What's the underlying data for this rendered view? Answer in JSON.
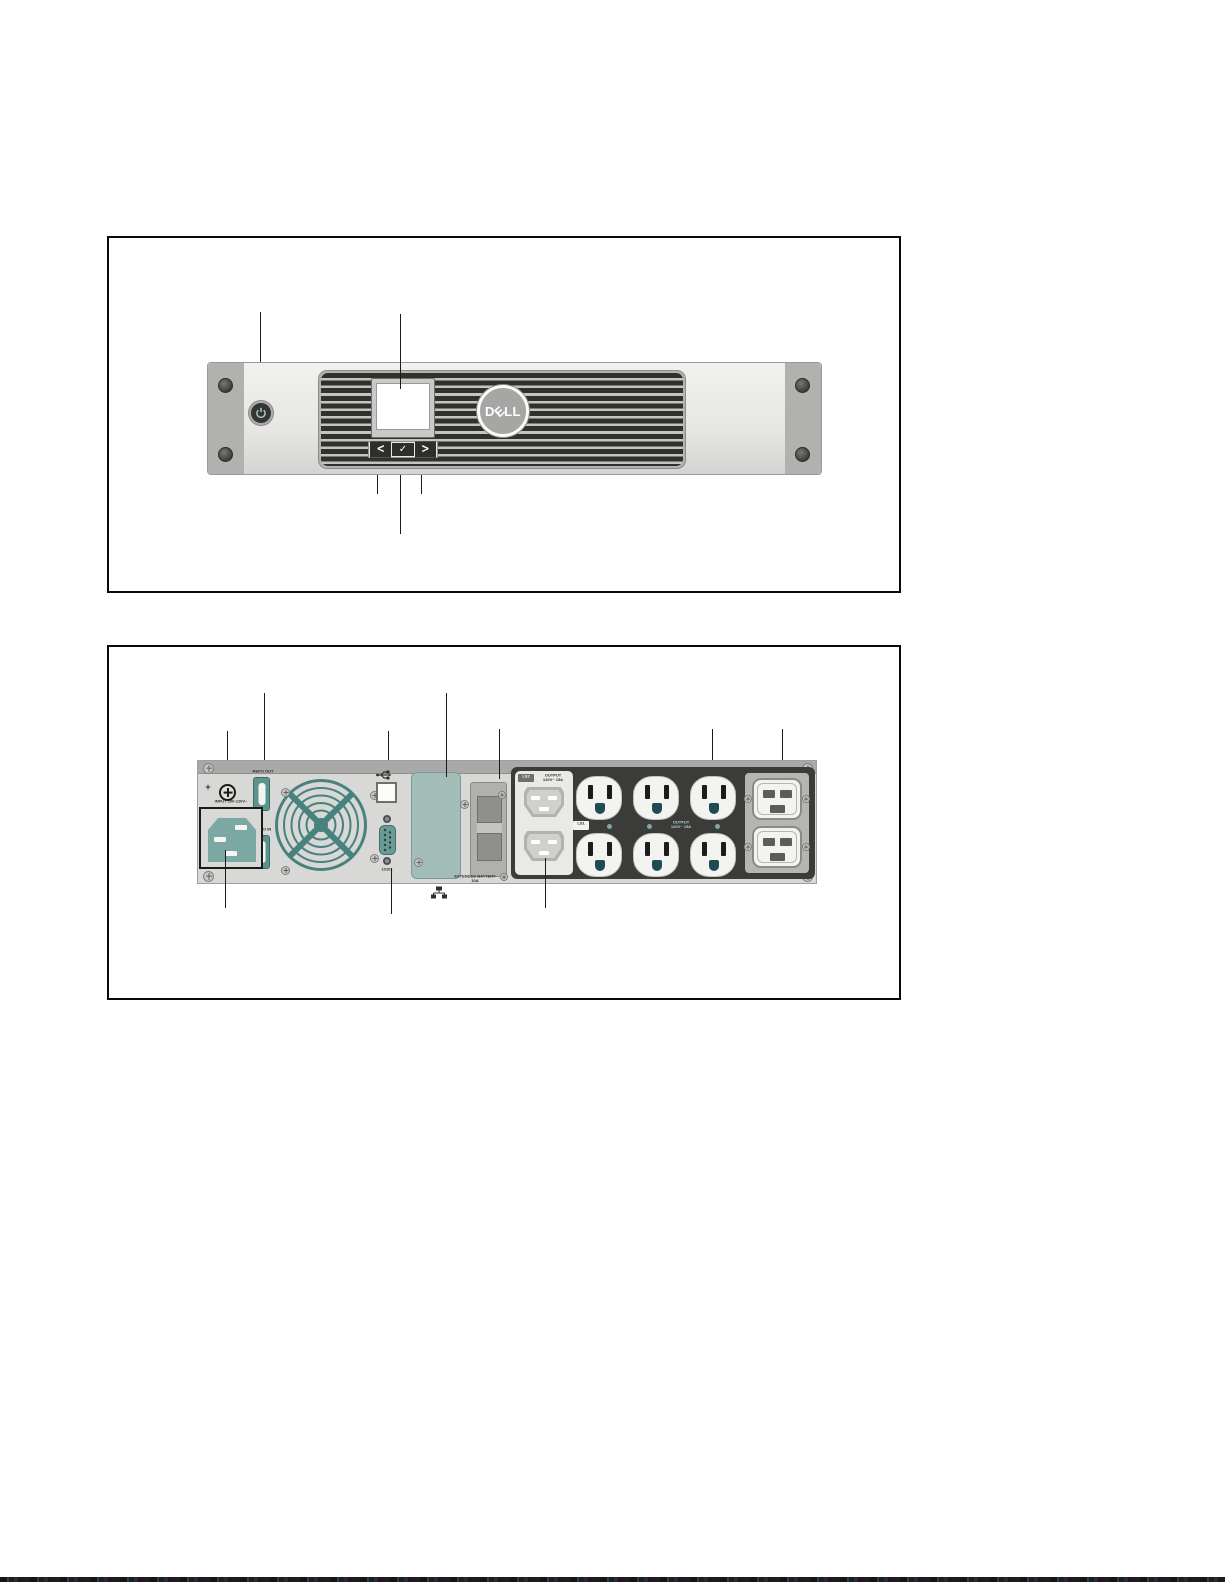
{
  "front_panel": {
    "logo_d": "D",
    "logo_e": "E",
    "logo_l1": "L",
    "logo_l2": "L",
    "button_left": "<",
    "button_enter": "✓",
    "button_right": ">"
  },
  "rear_panel": {
    "ground_symbol": "+",
    "repo_out_label": "REPO OUT",
    "repo_in_label": "REPO IN",
    "input_label": "INPUT 100-120V~",
    "serial_port_label": "10101",
    "ls2_badge": "LS2",
    "ls1_badge": "LS1",
    "ls2_output_line1": "OUTPUT",
    "ls2_output_line2": "120V~ 15A",
    "main_output_line1": "OUTPUT",
    "main_output_line2": "120V~ 15A",
    "ext_battery_line1": "EXTENDED BATTERY",
    "ext_battery_line2": "10A"
  },
  "colors": {
    "teal_accent": "#47827d",
    "chassis_gray": "#d8d8d6",
    "outlet_panel_dark": "#3b3b39",
    "ground_hole_teal": "#1d4d52"
  }
}
